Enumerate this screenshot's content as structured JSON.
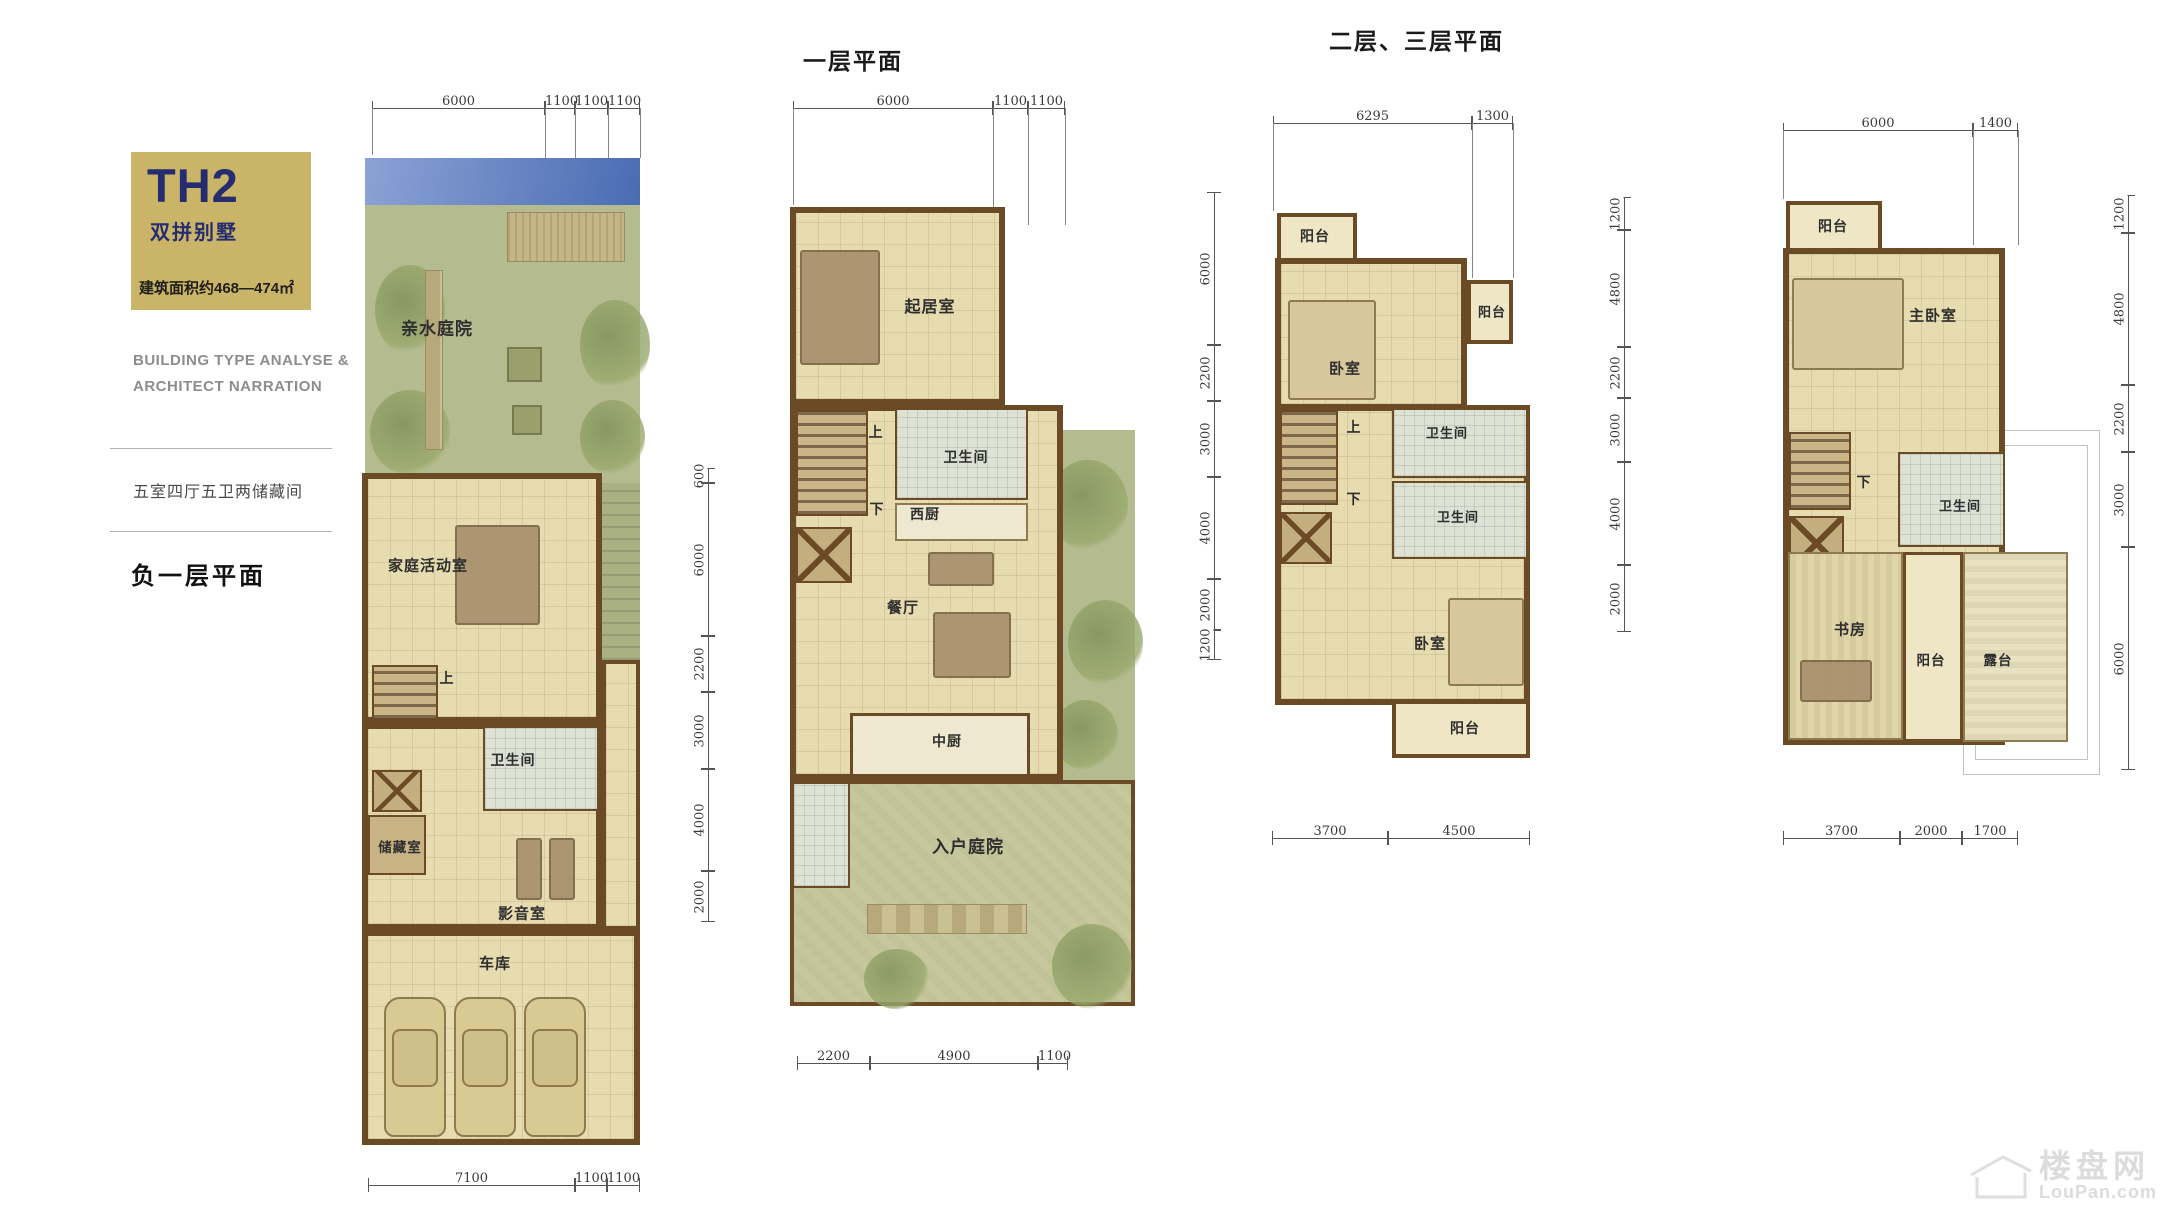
{
  "sidebar": {
    "unit_code": "TH2",
    "unit_type": "双拼别墅",
    "area_text": "建筑面积约468—474㎡",
    "en_line1": "BUILDING TYPE ANALYSE &",
    "en_line2": "ARCHITECT NARRATION",
    "layout_summary": "五室四厅五卫两储藏间",
    "floor_label": "负一层平面"
  },
  "headers": {
    "floor1": "一层平面",
    "floor23": "二层、三层平面"
  },
  "watermark": {
    "cn": "楼盘网",
    "en": "LouPan.com"
  },
  "colors": {
    "accent_gold": "#c9b468",
    "navy": "#252c6f",
    "wall_brown": "#6b4a26",
    "floor_beige": "#e7dbb0",
    "garden_green": "#b4bb8e",
    "water_blue": "#4a6cb4",
    "tile_gray": "#dde2d4",
    "balcony_cream": "#efe6c6"
  },
  "basement": {
    "top_dims": [
      "6000",
      "1100",
      "1100",
      "1100"
    ],
    "bottom_dims": [
      "7100",
      "1100",
      "1100"
    ],
    "side_dims": [
      "600",
      "6000",
      "2200",
      "3000",
      "4000",
      "2000"
    ],
    "rooms": {
      "water_garden": "亲水庭院",
      "family_room": "家庭活动室",
      "up": "上",
      "bathroom": "卫生间",
      "storage": "储藏室",
      "media_room": "影音室",
      "garage": "车库"
    }
  },
  "floor1": {
    "top_dims": [
      "6000",
      "1100",
      "1100"
    ],
    "bottom_dims": [
      "2200",
      "4900",
      "1100"
    ],
    "side_dims": [
      "6000",
      "2200",
      "3000",
      "4000",
      "2000",
      "1200"
    ],
    "rooms": {
      "living_room": "起居室",
      "up": "上",
      "down": "下",
      "bathroom": "卫生间",
      "west_kitchen": "西厨",
      "dining_room": "餐厅",
      "chinese_kitchen": "中厨",
      "entry_courtyard": "入户庭院"
    }
  },
  "floor2": {
    "top_dims": [
      "6295",
      "1300"
    ],
    "bottom_dims": [
      "3700",
      "4500"
    ],
    "side_dims": [
      "1200",
      "4800",
      "2200",
      "3000",
      "4000",
      "2000"
    ],
    "rooms": {
      "balcony_top": "阳台",
      "bedroom1": "卧室",
      "balcony_right": "阳台",
      "up": "上",
      "bathroom1": "卫生间",
      "down": "下",
      "bathroom2": "卫生间",
      "bedroom2": "卧室",
      "balcony_bottom": "阳台"
    }
  },
  "floor3": {
    "top_dims": [
      "6000",
      "1400"
    ],
    "bottom_dims": [
      "3700",
      "2000",
      "1700"
    ],
    "side_dims": [
      "1200",
      "4800",
      "2200",
      "3000",
      "6000"
    ],
    "rooms": {
      "balcony_top": "阳台",
      "master_bedroom": "主卧室",
      "down": "下",
      "bathroom": "卫生间",
      "study": "书房",
      "balcony": "阳台",
      "terrace": "露台"
    }
  }
}
